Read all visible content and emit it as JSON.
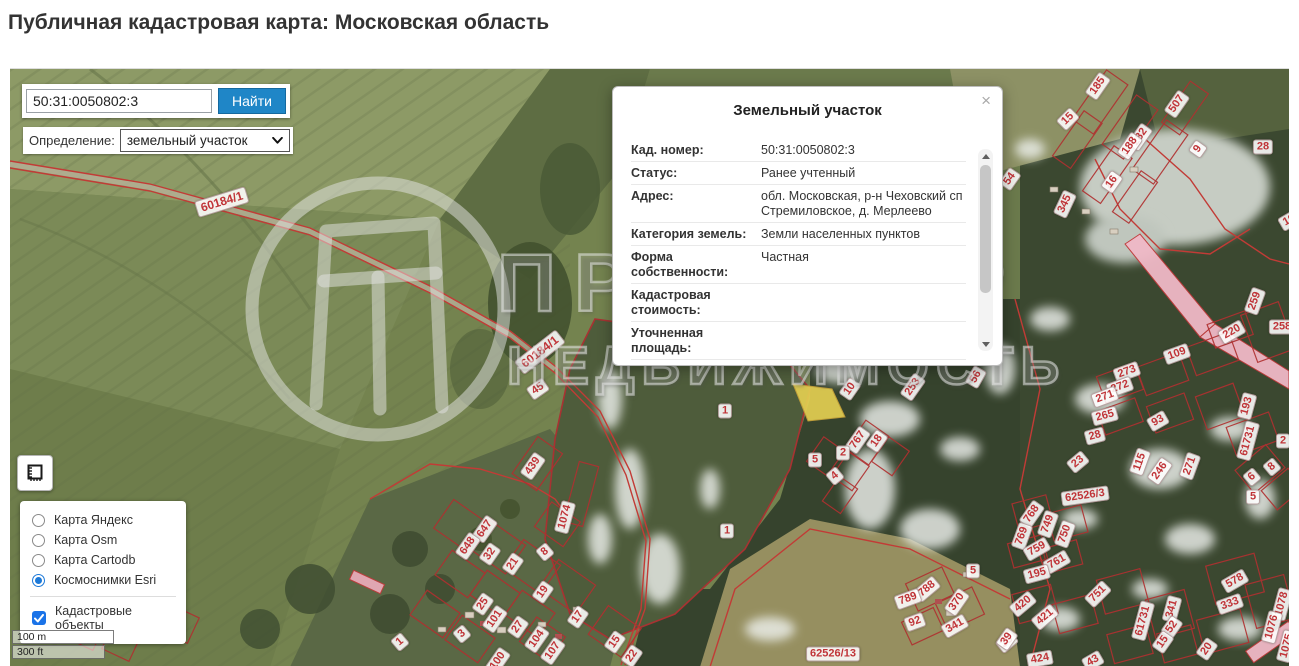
{
  "page": {
    "title": "Публичная кадастровая карта: Московская область"
  },
  "search": {
    "value": "50:31:0050802:3",
    "button": "Найти"
  },
  "definition": {
    "label": "Определение:",
    "selected": "земельный участок"
  },
  "popup": {
    "title": "Земельный участок",
    "close": "×",
    "rows": [
      {
        "label": "Кад. номер:",
        "value": "50:31:0050802:3"
      },
      {
        "label": "Статус:",
        "value": "Ранее учтенный"
      },
      {
        "label": "Адрес:",
        "value": "обл. Московская, р-н Чеховский сп Стремиловское, д. Мерлеево"
      },
      {
        "label": "Категория земель:",
        "value": "Земли населенных пунктов"
      },
      {
        "label": "Форма собственности:",
        "value": "Частная"
      },
      {
        "label": "Кадастровая стоимость:",
        "value": ""
      },
      {
        "label": "Уточненная площадь:",
        "value": ""
      },
      {
        "label": "Разрешенное",
        "value": "Для ведения личного подсобного"
      }
    ]
  },
  "layers": {
    "options": [
      {
        "label": "Карта Яндекс",
        "selected": false
      },
      {
        "label": "Карта Osm",
        "selected": false
      },
      {
        "label": "Карта Cartodb",
        "selected": false
      },
      {
        "label": "Космоснимки Esri",
        "selected": true
      }
    ],
    "overlay": {
      "label": "Кадастровые объекты",
      "checked": true
    }
  },
  "scale": {
    "metric": "100 m",
    "imperial": "300 ft"
  },
  "watermark": {
    "line1": "ПРОСТОР",
    "line2": "НЕДВИЖИМОСТЬ"
  },
  "colors": {
    "accent_blue": "#1f86c7",
    "parcel_red": "#c0392b",
    "highlight_yellow": "#e3cf52",
    "checkbox_blue": "#1a73e8"
  },
  "map": {
    "labels": [
      {
        "t": "60184/1",
        "x": 212,
        "y": 133,
        "r": -17,
        "road": true
      },
      {
        "t": "60184/1",
        "x": 530,
        "y": 283,
        "r": -38,
        "road": true
      },
      {
        "t": "45",
        "x": 528,
        "y": 320,
        "r": -35
      },
      {
        "t": "1",
        "x": 715,
        "y": 342,
        "r": 0
      },
      {
        "t": "1",
        "x": 717,
        "y": 462,
        "r": 0
      },
      {
        "t": "10",
        "x": 840,
        "y": 320,
        "r": -55
      },
      {
        "t": "253",
        "x": 903,
        "y": 318,
        "r": -55
      },
      {
        "t": "56",
        "x": 966,
        "y": 308,
        "r": -60
      },
      {
        "t": "767",
        "x": 848,
        "y": 371,
        "r": -55
      },
      {
        "t": "18",
        "x": 867,
        "y": 372,
        "r": -55
      },
      {
        "t": "2",
        "x": 833,
        "y": 384,
        "r": 0
      },
      {
        "t": "5",
        "x": 805,
        "y": 391,
        "r": 0
      },
      {
        "t": "4",
        "x": 825,
        "y": 407,
        "r": -40
      },
      {
        "t": "439",
        "x": 523,
        "y": 397,
        "r": -55
      },
      {
        "t": "1074",
        "x": 555,
        "y": 448,
        "r": -75
      },
      {
        "t": "647",
        "x": 475,
        "y": 460,
        "r": -55
      },
      {
        "t": "648",
        "x": 458,
        "y": 477,
        "r": -55
      },
      {
        "t": "32",
        "x": 480,
        "y": 485,
        "r": -55
      },
      {
        "t": "21",
        "x": 503,
        "y": 495,
        "r": -55
      },
      {
        "t": "8",
        "x": 535,
        "y": 483,
        "r": -40
      },
      {
        "t": "19",
        "x": 533,
        "y": 523,
        "r": -55
      },
      {
        "t": "25",
        "x": 473,
        "y": 535,
        "r": -55
      },
      {
        "t": "101",
        "x": 485,
        "y": 550,
        "r": -55
      },
      {
        "t": "3",
        "x": 452,
        "y": 565,
        "r": -40
      },
      {
        "t": "27",
        "x": 508,
        "y": 558,
        "r": -55
      },
      {
        "t": "104",
        "x": 527,
        "y": 570,
        "r": -55
      },
      {
        "t": "107",
        "x": 543,
        "y": 582,
        "r": -55
      },
      {
        "t": "17",
        "x": 568,
        "y": 548,
        "r": -55
      },
      {
        "t": "15",
        "x": 605,
        "y": 573,
        "r": -55
      },
      {
        "t": "22",
        "x": 622,
        "y": 587,
        "r": -55
      },
      {
        "t": "1",
        "x": 390,
        "y": 573,
        "r": -40
      },
      {
        "t": "100",
        "x": 488,
        "y": 592,
        "r": -55
      },
      {
        "t": "185",
        "x": 1088,
        "y": 17,
        "r": -55
      },
      {
        "t": "507",
        "x": 1167,
        "y": 35,
        "r": -55
      },
      {
        "t": "15",
        "x": 1058,
        "y": 50,
        "r": -45
      },
      {
        "t": "282",
        "x": 1130,
        "y": 68,
        "r": -55
      },
      {
        "t": "188",
        "x": 1120,
        "y": 77,
        "r": -55
      },
      {
        "t": "9",
        "x": 1188,
        "y": 80,
        "r": -55
      },
      {
        "t": "28",
        "x": 1253,
        "y": 78,
        "r": 0
      },
      {
        "t": "16",
        "x": 1102,
        "y": 113,
        "r": -55
      },
      {
        "t": "54",
        "x": 1000,
        "y": 110,
        "r": -55
      },
      {
        "t": "345",
        "x": 1055,
        "y": 135,
        "r": -65
      },
      {
        "t": "194",
        "x": 1282,
        "y": 150,
        "r": -30
      },
      {
        "t": "259",
        "x": 1245,
        "y": 232,
        "r": -70
      },
      {
        "t": "258",
        "x": 1272,
        "y": 258,
        "r": 0
      },
      {
        "t": "220",
        "x": 1222,
        "y": 263,
        "r": -30
      },
      {
        "t": "109",
        "x": 1167,
        "y": 285,
        "r": -20
      },
      {
        "t": "273",
        "x": 1117,
        "y": 303,
        "r": -20
      },
      {
        "t": "272",
        "x": 1110,
        "y": 318,
        "r": -20
      },
      {
        "t": "271",
        "x": 1095,
        "y": 328,
        "r": -20
      },
      {
        "t": "265",
        "x": 1095,
        "y": 347,
        "r": -15
      },
      {
        "t": "93",
        "x": 1148,
        "y": 352,
        "r": -30
      },
      {
        "t": "28",
        "x": 1085,
        "y": 367,
        "r": -15
      },
      {
        "t": "193",
        "x": 1237,
        "y": 337,
        "r": -75
      },
      {
        "t": "61731",
        "x": 1238,
        "y": 372,
        "r": -75
      },
      {
        "t": "2",
        "x": 1273,
        "y": 372,
        "r": 0
      },
      {
        "t": "23",
        "x": 1068,
        "y": 393,
        "r": -40
      },
      {
        "t": "115",
        "x": 1130,
        "y": 393,
        "r": -70
      },
      {
        "t": "246",
        "x": 1150,
        "y": 402,
        "r": -55
      },
      {
        "t": "271",
        "x": 1180,
        "y": 397,
        "r": -70
      },
      {
        "t": "62526/3",
        "x": 1075,
        "y": 427,
        "r": -8
      },
      {
        "t": "768",
        "x": 1022,
        "y": 445,
        "r": -55
      },
      {
        "t": "749",
        "x": 1038,
        "y": 455,
        "r": -70
      },
      {
        "t": "750",
        "x": 1055,
        "y": 465,
        "r": -70
      },
      {
        "t": "769",
        "x": 1012,
        "y": 467,
        "r": -70
      },
      {
        "t": "759",
        "x": 1027,
        "y": 480,
        "r": -30
      },
      {
        "t": "761",
        "x": 1047,
        "y": 493,
        "r": -30
      },
      {
        "t": "195",
        "x": 1027,
        "y": 505,
        "r": -15
      },
      {
        "t": "751",
        "x": 1088,
        "y": 525,
        "r": -45
      },
      {
        "t": "420",
        "x": 1013,
        "y": 535,
        "r": -40
      },
      {
        "t": "421",
        "x": 1035,
        "y": 548,
        "r": -40
      },
      {
        "t": "35",
        "x": 997,
        "y": 573,
        "r": -40
      },
      {
        "t": "424",
        "x": 1030,
        "y": 590,
        "r": -10
      },
      {
        "t": "43",
        "x": 1083,
        "y": 592,
        "r": -30
      },
      {
        "t": "61731",
        "x": 1133,
        "y": 552,
        "r": -75
      },
      {
        "t": "341",
        "x": 1162,
        "y": 540,
        "r": -75
      },
      {
        "t": "52",
        "x": 1162,
        "y": 558,
        "r": -55
      },
      {
        "t": "15",
        "x": 1153,
        "y": 573,
        "r": -55
      },
      {
        "t": "20",
        "x": 1197,
        "y": 580,
        "r": -55
      },
      {
        "t": "578",
        "x": 1225,
        "y": 512,
        "r": -30
      },
      {
        "t": "333",
        "x": 1220,
        "y": 535,
        "r": -20
      },
      {
        "t": "1078",
        "x": 1272,
        "y": 535,
        "r": -75
      },
      {
        "t": "1076",
        "x": 1262,
        "y": 558,
        "r": -75
      },
      {
        "t": "1075",
        "x": 1277,
        "y": 577,
        "r": -75
      },
      {
        "t": "6",
        "x": 1242,
        "y": 408,
        "r": -40
      },
      {
        "t": "8",
        "x": 1262,
        "y": 398,
        "r": -40
      },
      {
        "t": "5",
        "x": 1243,
        "y": 428,
        "r": 0
      },
      {
        "t": "62526/13",
        "x": 823,
        "y": 585,
        "r": 0
      },
      {
        "t": "788",
        "x": 917,
        "y": 520,
        "r": -40
      },
      {
        "t": "789",
        "x": 898,
        "y": 530,
        "r": -20
      },
      {
        "t": "92",
        "x": 905,
        "y": 553,
        "r": -20
      },
      {
        "t": "370",
        "x": 947,
        "y": 533,
        "r": -55
      },
      {
        "t": "341",
        "x": 945,
        "y": 557,
        "r": -30
      },
      {
        "t": "5",
        "x": 963,
        "y": 502,
        "r": 0
      },
      {
        "t": "39",
        "x": 997,
        "y": 570,
        "r": -55
      }
    ]
  }
}
